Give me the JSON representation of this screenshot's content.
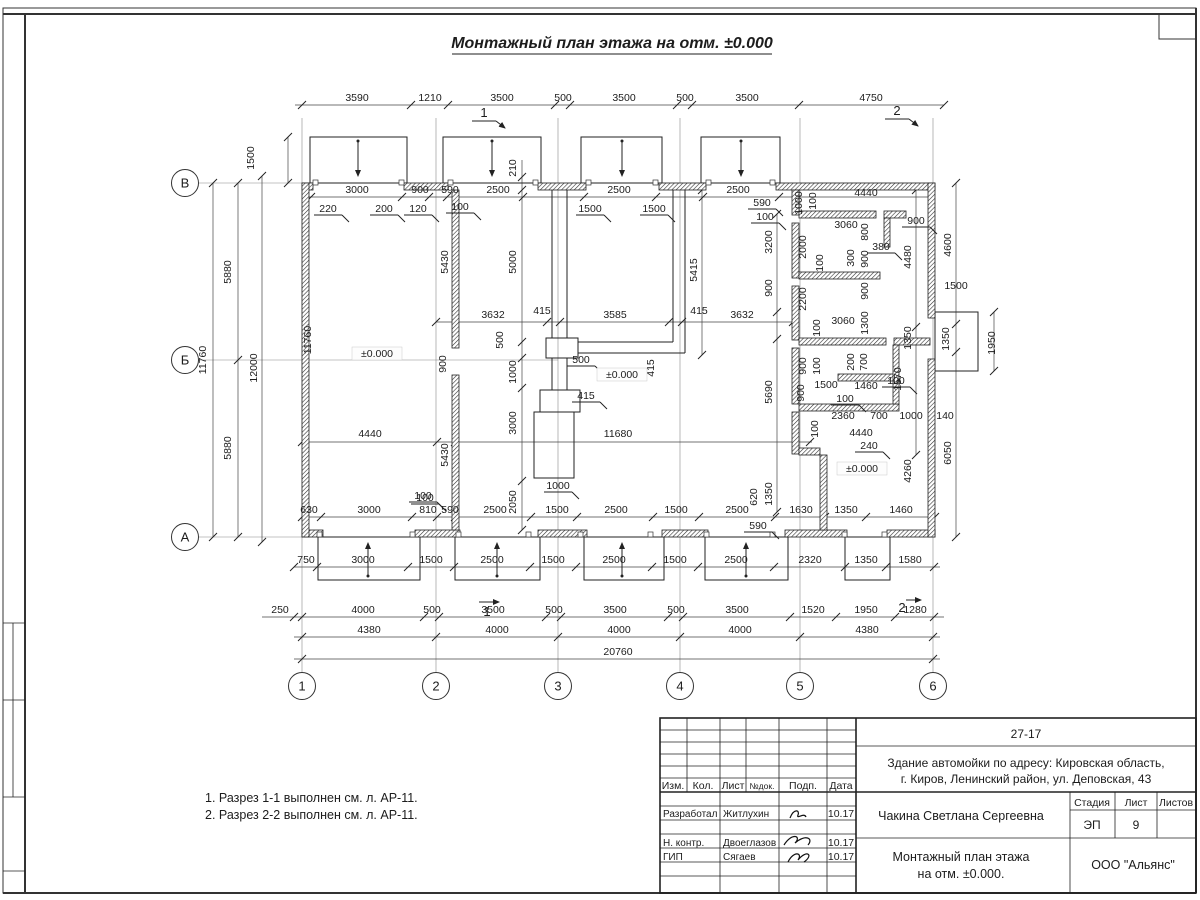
{
  "sheet": {
    "title": "Монтажный план этажа на отм. ±0.000",
    "notes": [
      "1. Разрез 1-1 выполнен см. л. АР-11.",
      "2. Разрез 2-2 выполнен см. л. АР-11."
    ]
  },
  "plan": {
    "level_mark": "±0.000",
    "axis_rows": [
      {
        "label": "В",
        "x": 185,
        "y": 183
      },
      {
        "label": "Б",
        "x": 185,
        "y": 360
      },
      {
        "label": "А",
        "x": 185,
        "y": 537
      }
    ],
    "axis_cols": [
      {
        "label": "1",
        "x": 302,
        "y": 686
      },
      {
        "label": "2",
        "x": 436,
        "y": 686
      },
      {
        "label": "3",
        "x": 558,
        "y": 686
      },
      {
        "label": "4",
        "x": 680,
        "y": 686
      },
      {
        "label": "5",
        "x": 800,
        "y": 686
      },
      {
        "label": "6",
        "x": 933,
        "y": 686
      }
    ],
    "section_marks": [
      {
        "label": "1",
        "x": 484,
        "y": 117
      },
      {
        "label": "2",
        "x": 897,
        "y": 115
      },
      {
        "label": "1",
        "x": 487,
        "y": 616
      },
      {
        "label": "2",
        "x": 902,
        "y": 612
      }
    ],
    "labels": [
      [
        "3590",
        357,
        101,
        ""
      ],
      [
        "1210",
        430,
        101,
        ""
      ],
      [
        "3500",
        502,
        101,
        ""
      ],
      [
        "500",
        563,
        101,
        ""
      ],
      [
        "3500",
        624,
        101,
        ""
      ],
      [
        "500",
        685,
        101,
        ""
      ],
      [
        "3500",
        747,
        101,
        ""
      ],
      [
        "4750",
        871,
        101,
        ""
      ],
      [
        "3000",
        357,
        193,
        ""
      ],
      [
        "900",
        420,
        193,
        ""
      ],
      [
        "590",
        450,
        193,
        ""
      ],
      [
        "2500",
        498,
        193,
        ""
      ],
      [
        "2500",
        619,
        193,
        ""
      ],
      [
        "2500",
        738,
        193,
        ""
      ],
      [
        "220",
        328,
        212,
        "u"
      ],
      [
        "200",
        384,
        212,
        "u"
      ],
      [
        "120",
        418,
        212,
        "u"
      ],
      [
        "100",
        460,
        210,
        "u"
      ],
      [
        "1500",
        590,
        212,
        "u"
      ],
      [
        "1500",
        654,
        212,
        "u"
      ],
      [
        "590",
        762,
        206,
        "u"
      ],
      [
        "100",
        765,
        220,
        "u"
      ],
      [
        "1500",
        254,
        158,
        "v"
      ],
      [
        "5880",
        231,
        272,
        "v"
      ],
      [
        "5880",
        231,
        448,
        "v"
      ],
      [
        "11760",
        206,
        360,
        "v"
      ],
      [
        "12000",
        257,
        368,
        "v"
      ],
      [
        "11760",
        311,
        340,
        "v"
      ],
      [
        "210",
        516,
        168,
        "v"
      ],
      [
        "5000",
        516,
        262,
        "v"
      ],
      [
        "5430",
        448,
        262,
        "v"
      ],
      [
        "5415",
        697,
        270,
        "v"
      ],
      [
        "3200",
        772,
        242,
        "v"
      ],
      [
        "900",
        772,
        288,
        "v"
      ],
      [
        "5690",
        772,
        392,
        "v"
      ],
      [
        "3632",
        493,
        318,
        ""
      ],
      [
        "415",
        542,
        314,
        ""
      ],
      [
        "3585",
        615,
        318,
        ""
      ],
      [
        "415",
        699,
        314,
        ""
      ],
      [
        "3632",
        742,
        318,
        ""
      ],
      [
        "500",
        503,
        340,
        "v"
      ],
      [
        "500",
        581,
        363,
        "u"
      ],
      [
        "1000",
        516,
        372,
        "v"
      ],
      [
        "900",
        446,
        364,
        "v"
      ],
      [
        "415",
        654,
        368,
        "v"
      ],
      [
        "415",
        586,
        399,
        "u"
      ],
      [
        "±0.000",
        377,
        357,
        "b"
      ],
      [
        "±0.000",
        622,
        378,
        "b"
      ],
      [
        "±0.000",
        862,
        472,
        "b"
      ],
      [
        "4440",
        370,
        437,
        ""
      ],
      [
        "11680",
        618,
        437,
        ""
      ],
      [
        "3000",
        516,
        423,
        "v"
      ],
      [
        "5430",
        448,
        455,
        "v"
      ],
      [
        "1000",
        558,
        489,
        "u"
      ],
      [
        "2050",
        516,
        502,
        "v"
      ],
      [
        "100",
        425,
        501,
        "u"
      ],
      [
        "630",
        309,
        513,
        ""
      ],
      [
        "3000",
        369,
        513,
        ""
      ],
      [
        "100",
        423,
        499,
        "u"
      ],
      [
        "810",
        428,
        513,
        ""
      ],
      [
        "590",
        450,
        513,
        ""
      ],
      [
        "2500",
        495,
        513,
        ""
      ],
      [
        "1500",
        557,
        513,
        ""
      ],
      [
        "2500",
        616,
        513,
        ""
      ],
      [
        "1500",
        676,
        513,
        ""
      ],
      [
        "2500",
        737,
        513,
        ""
      ],
      [
        "1630",
        801,
        513,
        ""
      ],
      [
        "1350",
        846,
        513,
        ""
      ],
      [
        "1460",
        901,
        513,
        ""
      ],
      [
        "620",
        757,
        497,
        "v"
      ],
      [
        "1350",
        772,
        494,
        "v"
      ],
      [
        "590",
        758,
        529,
        "u"
      ],
      [
        "750",
        306,
        563,
        ""
      ],
      [
        "3000",
        363,
        563,
        ""
      ],
      [
        "1500",
        431,
        563,
        ""
      ],
      [
        "2500",
        492,
        563,
        ""
      ],
      [
        "1500",
        553,
        563,
        ""
      ],
      [
        "2500",
        614,
        563,
        ""
      ],
      [
        "1500",
        675,
        563,
        ""
      ],
      [
        "2500",
        736,
        563,
        ""
      ],
      [
        "2320",
        810,
        563,
        ""
      ],
      [
        "1350",
        866,
        563,
        ""
      ],
      [
        "1580",
        910,
        563,
        ""
      ],
      [
        "250",
        280,
        613,
        ""
      ],
      [
        "4000",
        363,
        613,
        ""
      ],
      [
        "500",
        432,
        613,
        ""
      ],
      [
        "3500",
        493,
        613,
        ""
      ],
      [
        "500",
        554,
        613,
        ""
      ],
      [
        "3500",
        615,
        613,
        ""
      ],
      [
        "500",
        676,
        613,
        ""
      ],
      [
        "3500",
        737,
        613,
        ""
      ],
      [
        "1520",
        813,
        613,
        ""
      ],
      [
        "1950",
        866,
        613,
        ""
      ],
      [
        "1280",
        915,
        613,
        ""
      ],
      [
        "4380",
        369,
        633,
        ""
      ],
      [
        "4000",
        497,
        633,
        ""
      ],
      [
        "4000",
        619,
        633,
        ""
      ],
      [
        "4000",
        740,
        633,
        ""
      ],
      [
        "4380",
        867,
        633,
        ""
      ],
      [
        "20760",
        618,
        655,
        ""
      ],
      [
        "4440",
        866,
        196,
        ""
      ],
      [
        "1000",
        802,
        203,
        "v"
      ],
      [
        "100",
        816,
        201,
        "v"
      ],
      [
        "3060",
        846,
        228,
        ""
      ],
      [
        "800",
        868,
        232,
        "v"
      ],
      [
        "900",
        916,
        224,
        "u"
      ],
      [
        "380",
        881,
        250,
        "u"
      ],
      [
        "2000",
        806,
        247,
        "v"
      ],
      [
        "300",
        854,
        258,
        "v"
      ],
      [
        "900",
        868,
        259,
        "v"
      ],
      [
        "100",
        823,
        263,
        "v"
      ],
      [
        "4480",
        911,
        257,
        "v"
      ],
      [
        "4600",
        951,
        245,
        "v"
      ],
      [
        "2200",
        806,
        299,
        "v"
      ],
      [
        "900",
        868,
        291,
        "v"
      ],
      [
        "3060",
        843,
        324,
        ""
      ],
      [
        "1300",
        868,
        323,
        "v"
      ],
      [
        "100",
        820,
        328,
        "v"
      ],
      [
        "1500",
        956,
        289,
        ""
      ],
      [
        "1350",
        911,
        338,
        "v"
      ],
      [
        "1350",
        949,
        339,
        "v"
      ],
      [
        "1950",
        995,
        343,
        "v"
      ],
      [
        "900",
        806,
        366,
        "v"
      ],
      [
        "100",
        820,
        366,
        "v"
      ],
      [
        "200",
        854,
        362,
        "v"
      ],
      [
        "700",
        867,
        362,
        "v"
      ],
      [
        "1500",
        826,
        388,
        ""
      ],
      [
        "1460",
        866,
        389,
        ""
      ],
      [
        "100",
        845,
        402,
        "u"
      ],
      [
        "1570",
        901,
        379,
        "v"
      ],
      [
        "100",
        896,
        384,
        "u"
      ],
      [
        "900",
        804,
        393,
        "v"
      ],
      [
        "2360",
        843,
        419,
        ""
      ],
      [
        "700",
        879,
        419,
        ""
      ],
      [
        "1000",
        911,
        419,
        ""
      ],
      [
        "140",
        945,
        419,
        ""
      ],
      [
        "100",
        818,
        429,
        "v"
      ],
      [
        "4440",
        861,
        436,
        ""
      ],
      [
        "240",
        869,
        449,
        "u"
      ],
      [
        "4260",
        911,
        471,
        "v"
      ],
      [
        "6050",
        951,
        453,
        "v"
      ]
    ]
  },
  "title_block": {
    "code": "27-17",
    "project_line1": "Здание автомойки по адресу: Кировская область,",
    "project_line2": "г. Киров, Ленинский район, ул. Деповская, 43",
    "columns": [
      "Изм.",
      "Кол.",
      "Лист",
      "№док.",
      "Подп.",
      "Дата"
    ],
    "rows": [
      {
        "role": "Разработал",
        "name": "Житлухин",
        "date": "10.17"
      },
      {
        "role": "Н. контр.",
        "name": "Двоеглазов",
        "date": "10.17"
      },
      {
        "role": "ГИП",
        "name": "Сягаев",
        "date": "10.17"
      }
    ],
    "author": "Чакина Светлана Сергеевна",
    "stage_label": "Стадия",
    "sheet_label": "Лист",
    "sheets_label": "Листов",
    "stage": "ЭП",
    "sheet_no": "9",
    "drawing_title1": "Монтажный план этажа",
    "drawing_title2": "на отм. ±0.000.",
    "org": "ООО \"Альянс\""
  }
}
